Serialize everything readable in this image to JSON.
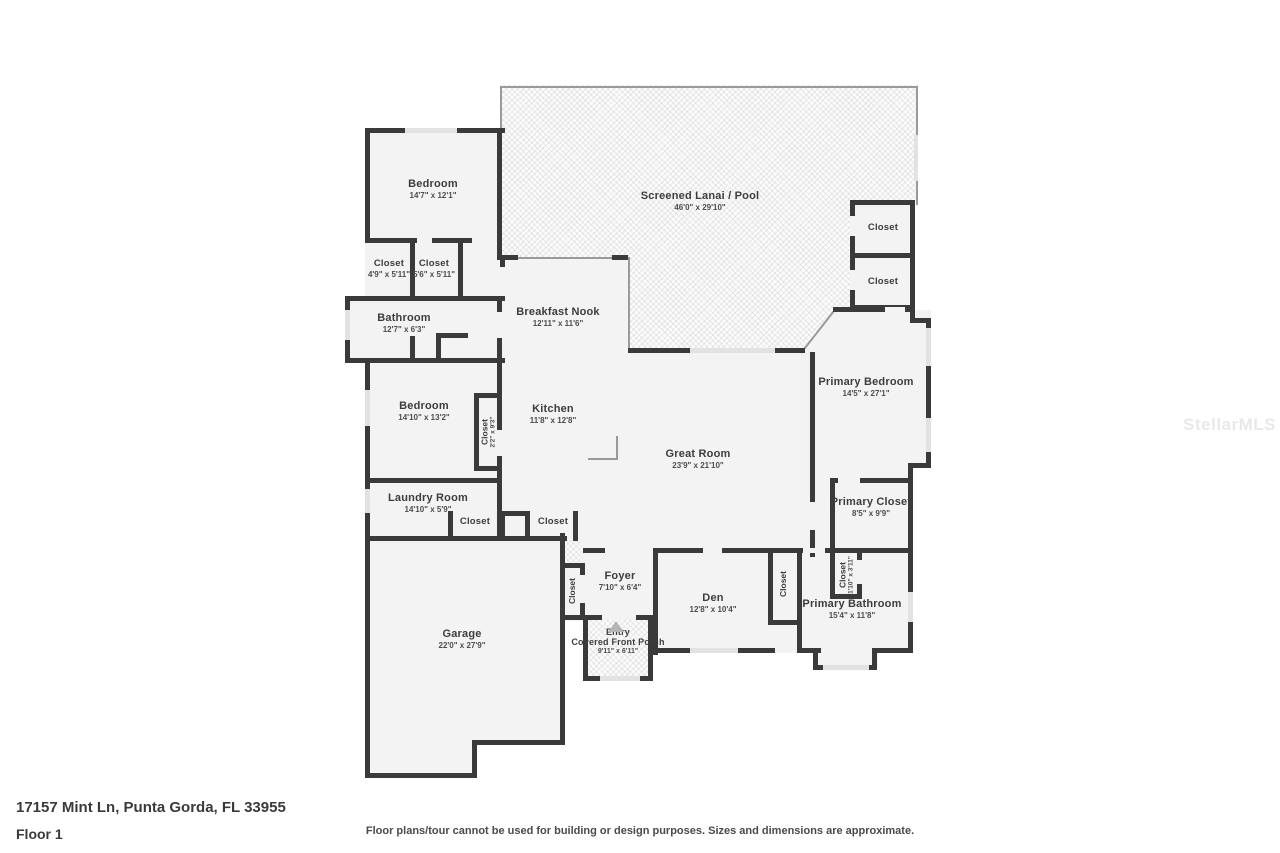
{
  "page": {
    "address": "17157 Mint Ln, Punta Gorda, FL 33955",
    "floor_label": "Floor 1",
    "disclaimer": "Floor plans/tour cannot be used for building or design purposes. Sizes and dimensions are approximate.",
    "watermark": "StellarMLS"
  },
  "colors": {
    "wall": "#3a3a3a",
    "floor_fill": "#f3f3f3",
    "window": "#e2e2e2",
    "hatch_background": "#fbfbfb",
    "label_text": "#3d3d3d"
  },
  "rooms": {
    "bedroom_top": {
      "name": "Bedroom",
      "dims": "14'7\" x 12'1\""
    },
    "lanai": {
      "name": "Screened Lanai / Pool",
      "dims": "46'0\" x 29'10\""
    },
    "closet_hall_top": {
      "name": "Closet"
    },
    "closet_hall_bottom": {
      "name": "Closet"
    },
    "closet_left_a": {
      "name": "Closet",
      "dims": "4'9\" x 5'11\""
    },
    "closet_left_b": {
      "name": "Closet",
      "dims": "5'6\" x 5'11\""
    },
    "bathroom": {
      "name": "Bathroom",
      "dims": "12'7\" x 6'3\""
    },
    "breakfast_nook": {
      "name": "Breakfast Nook",
      "dims": "12'11\" x 11'6\""
    },
    "bedroom_mid": {
      "name": "Bedroom",
      "dims": "14'10\" x 13'2\""
    },
    "closet_bedroom_mid": {
      "name": "Closet",
      "dims": "2'2\" x 9'3\""
    },
    "kitchen": {
      "name": "Kitchen",
      "dims": "11'8\" x 12'8\""
    },
    "great_room": {
      "name": "Great Room",
      "dims": "23'9\" x 21'10\""
    },
    "primary_bedroom": {
      "name": "Primary Bedroom",
      "dims": "14'5\" x 27'1\""
    },
    "laundry": {
      "name": "Laundry Room",
      "dims": "14'10\" x 5'9\""
    },
    "closet_hall_a": {
      "name": "Closet"
    },
    "closet_hall_b": {
      "name": "Closet"
    },
    "primary_closet": {
      "name": "Primary Closet",
      "dims": "8'5\" x 9'9\""
    },
    "foyer": {
      "name": "Foyer",
      "dims": "7'10\" x 6'4\""
    },
    "closet_foyer": {
      "name": "Closet"
    },
    "den": {
      "name": "Den",
      "dims": "12'8\" x 10'4\""
    },
    "closet_den": {
      "name": "Closet"
    },
    "closet_bath": {
      "name": "Closet",
      "dims": "1'10\" x 3'11\""
    },
    "primary_bathroom": {
      "name": "Primary Bathroom",
      "dims": "15'4\" x 11'8\""
    },
    "garage": {
      "name": "Garage",
      "dims": "22'0\" x 27'9\""
    },
    "entry": {
      "line1": "Entry",
      "line2": "Covered Front Porch",
      "dims": "9'11\" x 6'11\""
    }
  }
}
